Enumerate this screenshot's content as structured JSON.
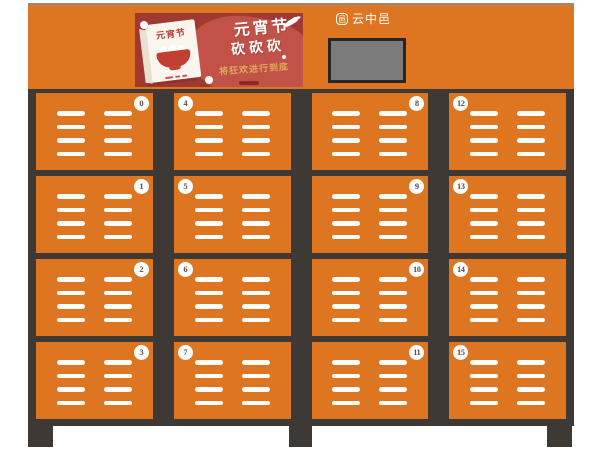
{
  "colors": {
    "orange": "#DE7520",
    "frame": "#3F3935",
    "banner_bg": "#A23931",
    "banner_blob": "#C25247",
    "gold": "#E0A95B",
    "screen_fill": "#7B7B7B",
    "screen_border": "#262626",
    "badge_bg": "#FFFFFF",
    "badge_text": "#55504C",
    "card_red": "#B5392F"
  },
  "header": {
    "brand": {
      "seal_char": "邑",
      "name": "云中邑"
    },
    "banner": {
      "calendar_title": "元宵节",
      "headline_line1": "元宵节",
      "headline_line2": "砍砍砍",
      "subhead": "将狂欢进行到底"
    }
  },
  "lockers": [
    {
      "number": "0",
      "badge_side": "right"
    },
    {
      "number": "1",
      "badge_side": "right"
    },
    {
      "number": "2",
      "badge_side": "right"
    },
    {
      "number": "3",
      "badge_side": "right"
    },
    {
      "number": "4",
      "badge_side": "left"
    },
    {
      "number": "5",
      "badge_side": "left"
    },
    {
      "number": "6",
      "badge_side": "left"
    },
    {
      "number": "7",
      "badge_side": "left"
    },
    {
      "number": "8",
      "badge_side": "right"
    },
    {
      "number": "9",
      "badge_side": "right"
    },
    {
      "number": "10",
      "badge_side": "right"
    },
    {
      "number": "11",
      "badge_side": "right"
    },
    {
      "number": "12",
      "badge_side": "left"
    },
    {
      "number": "13",
      "badge_side": "left"
    },
    {
      "number": "14",
      "badge_side": "left"
    },
    {
      "number": "15",
      "badge_side": "left"
    }
  ]
}
